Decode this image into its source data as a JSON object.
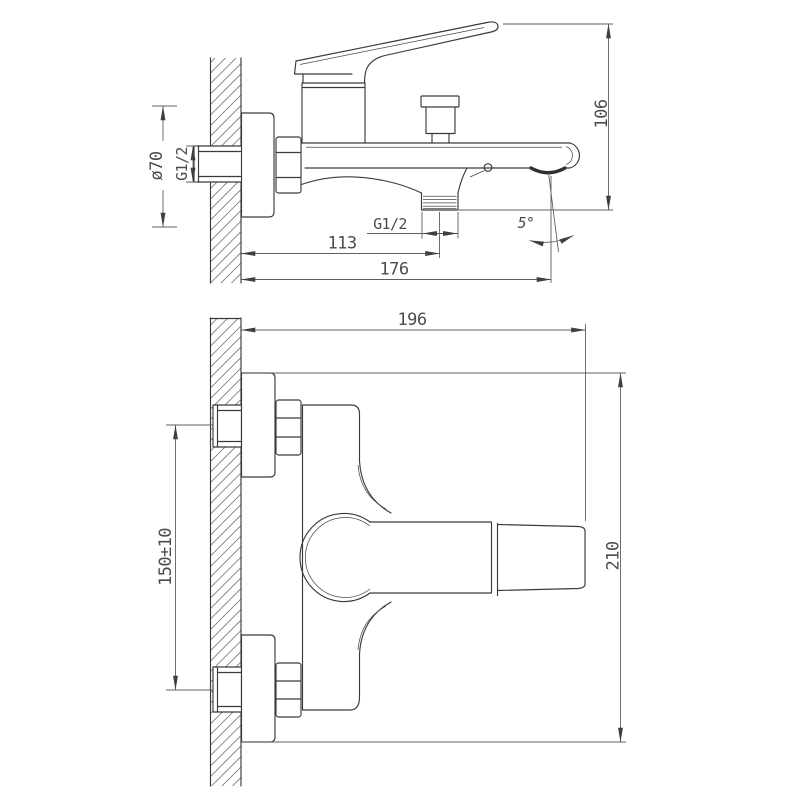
{
  "drawing": {
    "colors": {
      "background": "#ffffff",
      "outline": "#3a3a3a",
      "dimension_lines": "#5f5f5f",
      "text": "#4c4c4c"
    },
    "side_view": {
      "dims": {
        "flange_diameter": "ø70",
        "inlet_thread": "G1/2",
        "wall_to_shower_outlet": "113",
        "wall_to_spout_end": "176",
        "outlet_thread": "G1/2",
        "spout_drop_height": "106",
        "spout_angle": "5°"
      }
    },
    "front_view": {
      "dims": {
        "wall_to_handle_tip": "196",
        "inlet_spacing": "150±10",
        "overall_height": "210"
      }
    }
  }
}
